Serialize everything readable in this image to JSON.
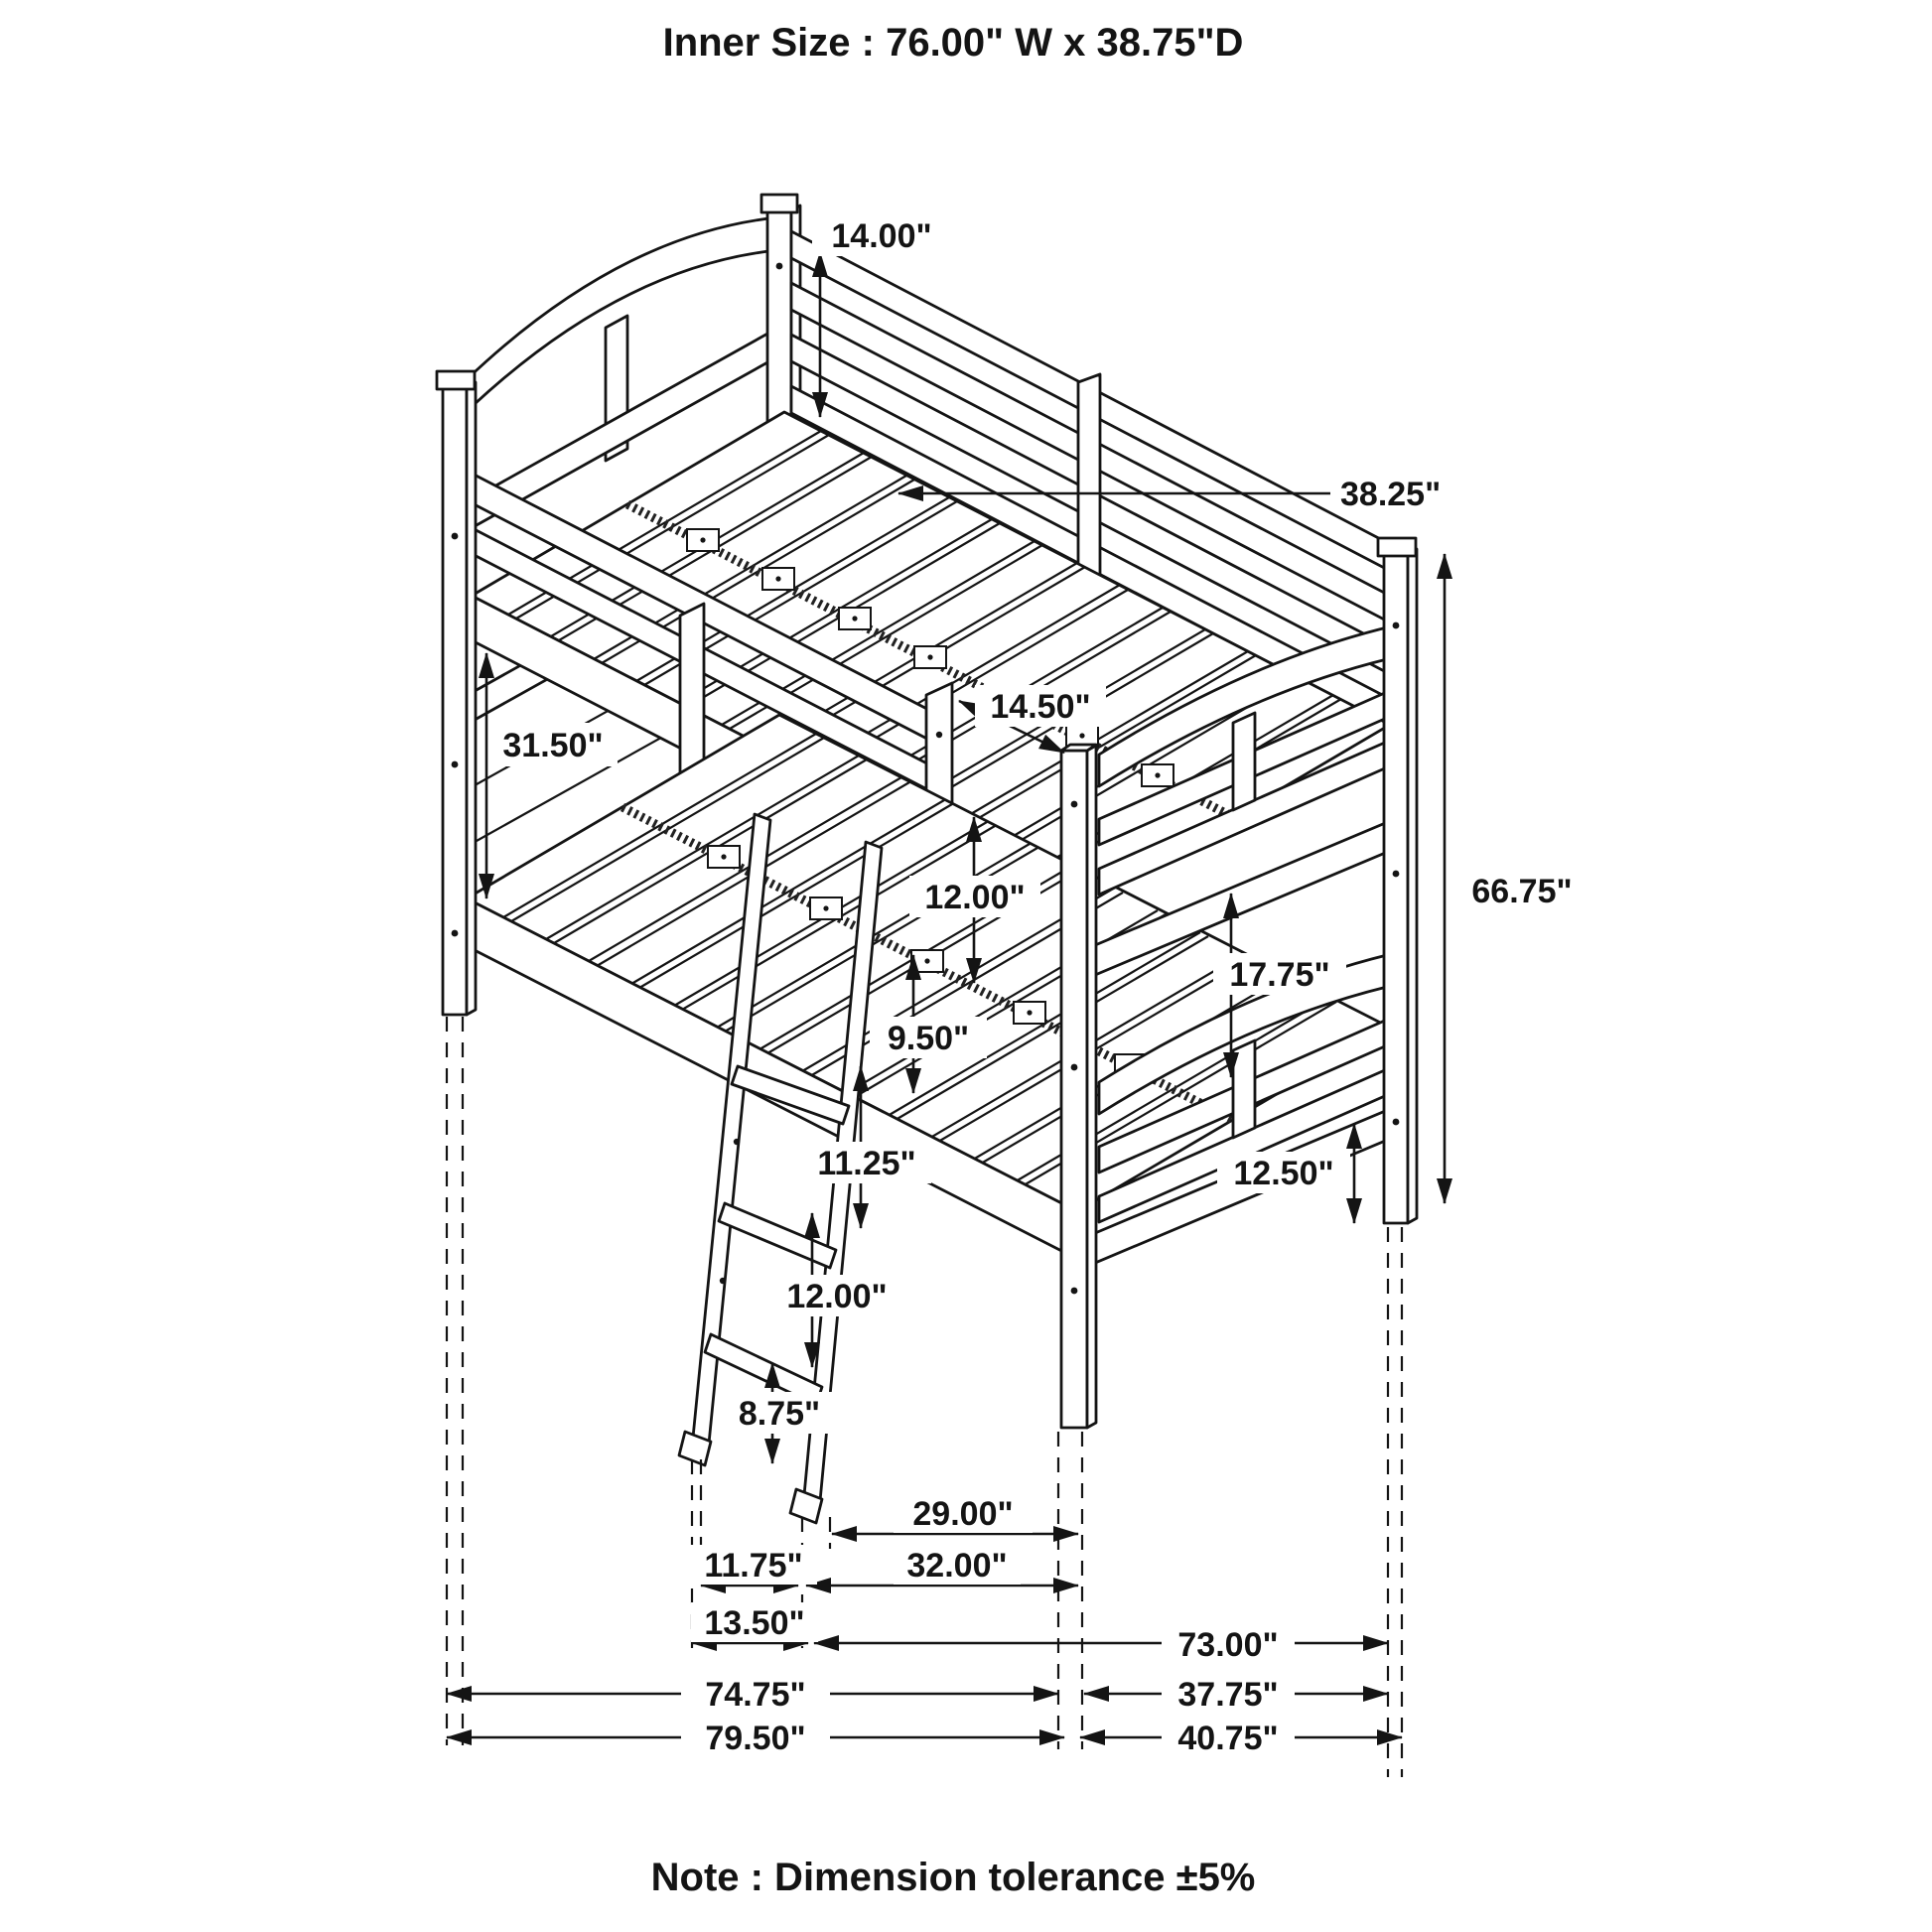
{
  "title": "Inner Size : 76.00\" W x  38.75\"D",
  "note": "Note : Dimension tolerance ±5%",
  "colors": {
    "line": "#141414",
    "background": "#ffffff"
  },
  "drawing": {
    "type": "isometric-line-art",
    "subject": "twin-over-twin bunk bed with ladder"
  },
  "dimensions": {
    "upper_guard_height": "14.00\"",
    "slat_depth": "38.25\"",
    "bunk_clearance": "31.50\"",
    "guard_post_height": "14.50\"",
    "guard_opening_height": "12.00\"",
    "foot_panel_height": "17.75\"",
    "overall_height": "66.75\"",
    "ladder_gap_top": "9.50\"",
    "ladder_gap_2": "11.25\"",
    "ladder_gap_3": "12.00\"",
    "ladder_gap_bottom": "8.75\"",
    "foot_rail_height": "12.50\"",
    "ladder_to_foot_post": "29.00\"",
    "ladder_inner_width": "11.75\"",
    "ladder_to_foot_post_outer": "32.00\"",
    "ladder_outer_width": "13.50\"",
    "frame_length_inner": "73.00\"",
    "frame_length_mid": "74.75\"",
    "frame_depth_inner": "37.75\"",
    "frame_length_overall": "79.50\"",
    "frame_depth_overall": "40.75\""
  }
}
